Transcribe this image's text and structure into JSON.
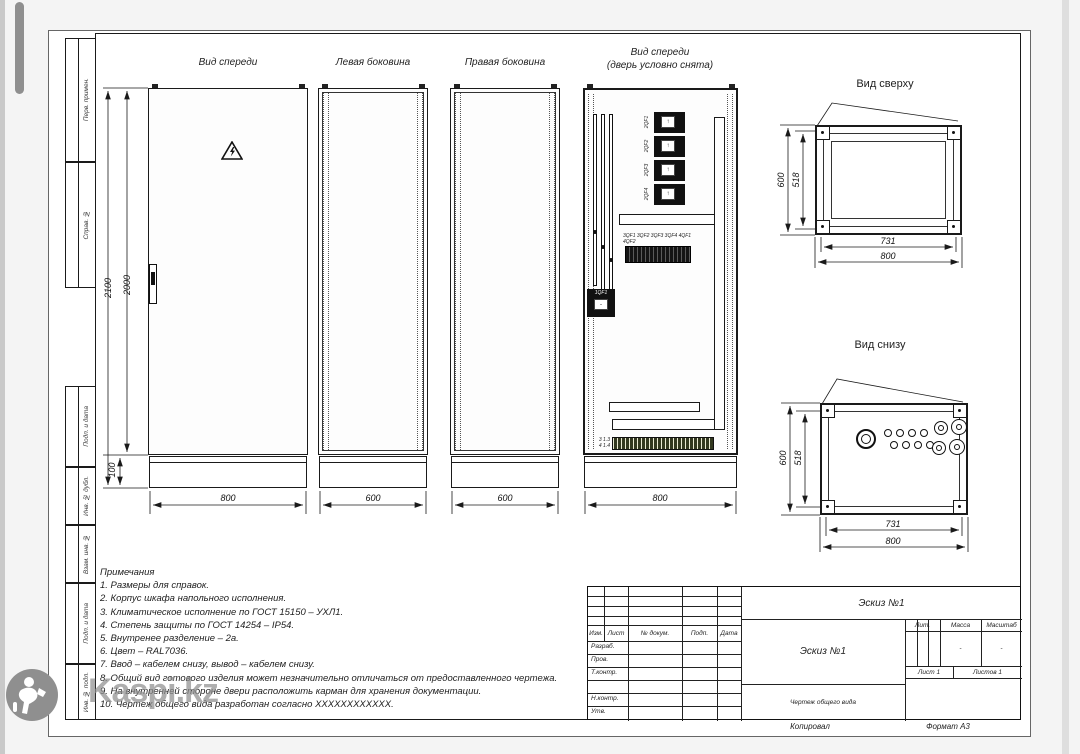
{
  "colors": {
    "line": "#1a1a1a",
    "sheet": "#ffffff",
    "background": "#f4f4f4",
    "watermark": "#8f8f8f",
    "terminal_strip": "#32381f"
  },
  "margin_labels": [
    "Перв. примен.",
    "Справ. №",
    "Подп. и дата",
    "Инв. № дубл.",
    "Взам. инв. №",
    "Подп. и дата",
    "Инв. № подл."
  ],
  "views": {
    "front": {
      "label": "Вид спереди",
      "dim_height_total": "2100",
      "dim_height_body": "2000",
      "dim_plinth": "100",
      "dim_width": "800"
    },
    "left_side": {
      "label": "Левая боковина",
      "dim_width": "600"
    },
    "right_side": {
      "label": "Правая боковина",
      "dim_width": "600"
    },
    "internal": {
      "label": "Вид спереди",
      "sublabel": "(дверь условно снята)",
      "dim_width": "800",
      "main_breaker": "1QF1",
      "feeders": [
        "2QF1",
        "2QF2",
        "2QF3",
        "2QF4"
      ],
      "din_row_label": "3QF1 3QF2 3QF3 3QF4 4QF1 4QF2",
      "terminal_marks": [
        "3 1.3",
        "4 1.4"
      ]
    },
    "top": {
      "label": "Вид сверху",
      "dim_height": "600",
      "dim_height_inner": "518",
      "dim_width_inner": "731",
      "dim_width": "800"
    },
    "bottom": {
      "label": "Вид снизу",
      "dim_height": "600",
      "dim_height_inner": "518",
      "dim_width_inner": "731",
      "dim_width": "800"
    }
  },
  "notes": {
    "title": "Примечания",
    "items": [
      "1. Размеры для справок.",
      "2. Корпус шкафа напольного исполнения.",
      "3. Климатическое исполнение по ГОСТ 15150 – УХЛ1.",
      "4. Степень защиты по ГОСТ 14254 – IP54.",
      "5. Внутренее разделение – 2а.",
      "6. Цвет – RAL7036.",
      "7. Ввод – кабелем снизу, вывод – кабелем снизу.",
      "8. Общий вид готового изделия может незначительно отличаться от предоставленного чертежа.",
      "9. На внутренней стороне двери расположить карман для хранения документации.",
      "10. Чертеж общего вида разработан согласно XXXXXXXXXXXX."
    ]
  },
  "title_block": {
    "doc_title": "Эскиз №1",
    "doc_name": "Эскиз №1",
    "doc_type": "Чертеж общего вида",
    "cols": {
      "izm": "Изм.",
      "list": "Лист",
      "docum": "№ докум.",
      "podp": "Подп.",
      "data": "Дата"
    },
    "rows": {
      "razrab": "Разраб.",
      "prov": "Пров.",
      "tkontr": "Т.контр.",
      "nkontr": "Н.контр.",
      "utv": "Утв."
    },
    "lit": "Лит.",
    "massa": "Масса",
    "masshtab": "Масштаб",
    "massa_value": "-",
    "masshtab_value": "-",
    "sheet": "Лист 1",
    "sheets": "Листов 1",
    "kopiroval": "Копировал",
    "format": "Формат А3"
  },
  "watermark": {
    "brand": "Kaspi.kz"
  }
}
